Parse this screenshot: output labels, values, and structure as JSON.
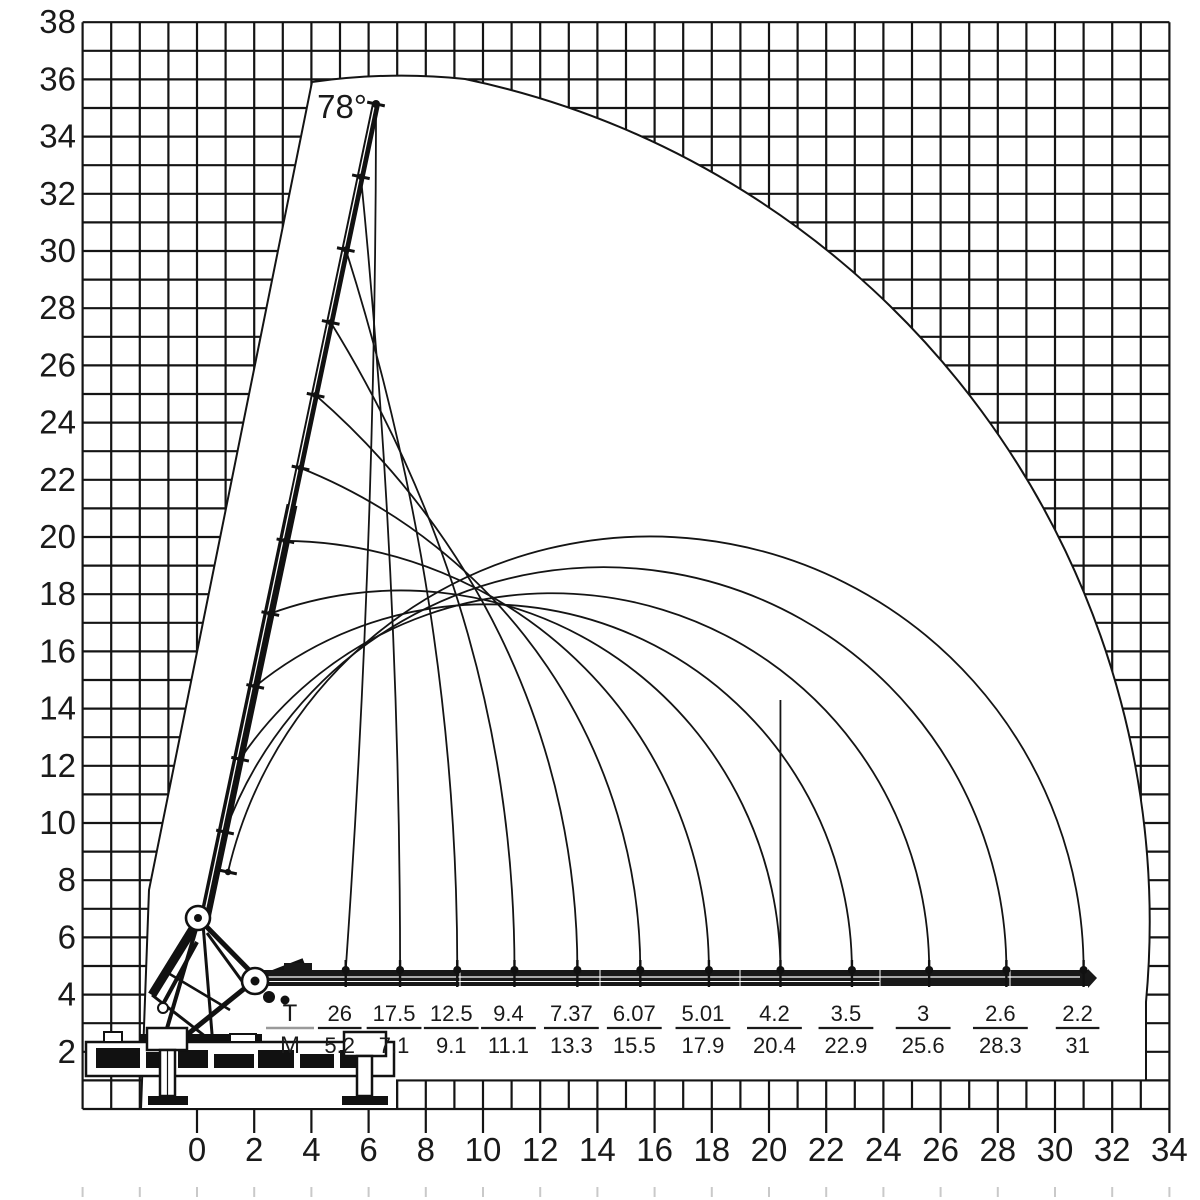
{
  "angle_label": "78°",
  "axes": {
    "y_ticks": [
      38,
      36,
      34,
      32,
      30,
      28,
      26,
      24,
      22,
      20,
      18,
      16,
      14,
      12,
      10,
      8,
      6,
      4,
      2
    ],
    "x_ticks": [
      0,
      2,
      4,
      6,
      8,
      10,
      12,
      14,
      16,
      18,
      20,
      22,
      24,
      26,
      28,
      30,
      32,
      34
    ]
  },
  "load_table": {
    "numerator_label": "T",
    "denominator_label": "M",
    "entries": [
      {
        "t": "26",
        "m": "5.2"
      },
      {
        "t": "17.5",
        "m": "7.1"
      },
      {
        "t": "12.5",
        "m": "9.1"
      },
      {
        "t": "9.4",
        "m": "11.1"
      },
      {
        "t": "7.37",
        "m": "13.3"
      },
      {
        "t": "6.07",
        "m": "15.5"
      },
      {
        "t": "5.01",
        "m": "17.9"
      },
      {
        "t": "4.2",
        "m": "20.4"
      },
      {
        "t": "3.5",
        "m": "22.9"
      },
      {
        "t": "3",
        "m": "25.6"
      },
      {
        "t": "2.6",
        "m": "28.3"
      },
      {
        "t": "2.2",
        "m": "31"
      }
    ]
  },
  "chart_data": {
    "type": "table",
    "title": "",
    "boom_angle_deg": 78,
    "x_axis": {
      "range": [
        0,
        34
      ],
      "tick_step": 2,
      "gridline_step": 1
    },
    "y_axis": {
      "range": [
        0,
        38
      ],
      "tick_step": 2,
      "gridline_step": 1
    },
    "grid": "on",
    "series": [
      {
        "name": "T",
        "values": [
          26,
          17.5,
          12.5,
          9.4,
          7.37,
          6.07,
          5.01,
          4.2,
          3.5,
          3,
          2.6,
          2.2
        ]
      },
      {
        "name": "M",
        "values": [
          5.2,
          7.1,
          9.1,
          11.1,
          13.3,
          15.5,
          17.9,
          20.4,
          22.9,
          25.6,
          28.3,
          31
        ]
      }
    ]
  },
  "colors": {
    "line": "#141414",
    "text": "#1a1a1a",
    "crane": "#111111",
    "header_bar": "#9a9a9a",
    "faint_mark": "#c9c9c9",
    "background": "#ffffff"
  }
}
